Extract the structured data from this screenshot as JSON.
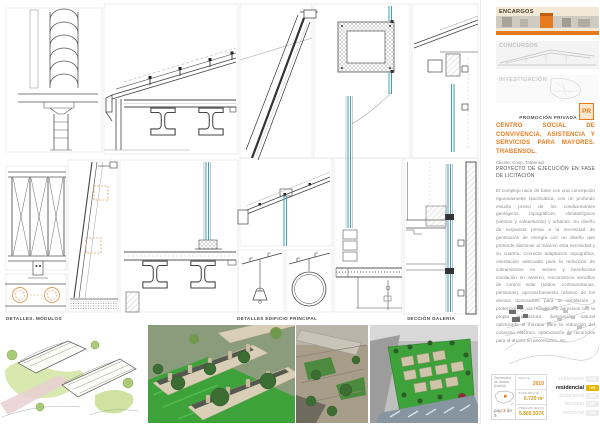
{
  "colors": {
    "accent": "#e87a1e",
    "highlight": "#e5b602",
    "glazing_blue": "#3aa0b8",
    "drawing_line": "#4a4a4a"
  },
  "main": {
    "captions": [
      "DETALLES. MÓDULOS",
      "DETALLES EDIFICIO PRINCIPAL",
      "SECCIÓN GALERÍA"
    ],
    "images": [
      "aerial-sketch-render",
      "housing-rows-render",
      "courtyard-render",
      "site-model-aerial-render"
    ]
  },
  "sidebar": {
    "nav": [
      {
        "label": "ENCARGOS",
        "active": true
      },
      {
        "label": "CONCURSOS",
        "active": false
      },
      {
        "label": "INVESTIGACIÓN",
        "active": false
      }
    ],
    "promo_label": "PROMOCIÓN PRIVADA",
    "promo_badge": "PR",
    "project": {
      "title": "CENTRO SOCIAL DE CONVIVENCIA, ASISTENCIA Y SERVICIOS PARA MAYORES. TRABENSOL.",
      "client": "Cliente: Coop. Trabensol",
      "phase": "PROYECTO DE EJECUCIÓN EN FASE DE LICITACIÓN",
      "description": "El complejo nace de base con una concepción rigurosamente bioclimática, con un profundo estudio previo de los condicionantes geológicos, topográficos, climatológicos (vientos y soleamiento) y urbanos. Su diseño da respuesta previa a la necesidad de generación de energía con un diseño que pretende disminuir al máximo esta necesidad y su cuantía. Correcta adaptación topográfica, orientación adecuada para la reducción de soleamientos en verano y beneficiosa insolación en invierno, mecanismos sencillos de control solar (toldos, contraventanas, persianas), aprovechamiento máximo de los vientos dominantes para la ventilación y protección de los más fríos y agresivos con la propia arquitectura, iluminación natural optimizada al máximo para la reducción del consumo eléctrico, optimización de recorridos para el ahorro en ascensores, etc."
    },
    "info": {
      "location": "Torremocha de Jarama (Madrid)",
      "page_label": "pag",
      "page_current": "3",
      "page_of": "de 5",
      "fields": [
        {
          "label": "FECHA",
          "value": "2010"
        },
        {
          "label": "SUPERFICIE",
          "value": "6.720 m²"
        },
        {
          "label": "PRESUPUESTO",
          "value": "5.805.937€"
        }
      ],
      "categories": [
        {
          "label": "urbanismo",
          "badge": "urb",
          "active": false
        },
        {
          "label": "residencial",
          "badge": "res",
          "active": true
        },
        {
          "label": "dotacional",
          "badge": "dot",
          "active": false
        },
        {
          "label": "terciario",
          "badge": "ter",
          "active": false
        },
        {
          "label": "industrial",
          "badge": "ind",
          "active": false
        }
      ]
    }
  }
}
